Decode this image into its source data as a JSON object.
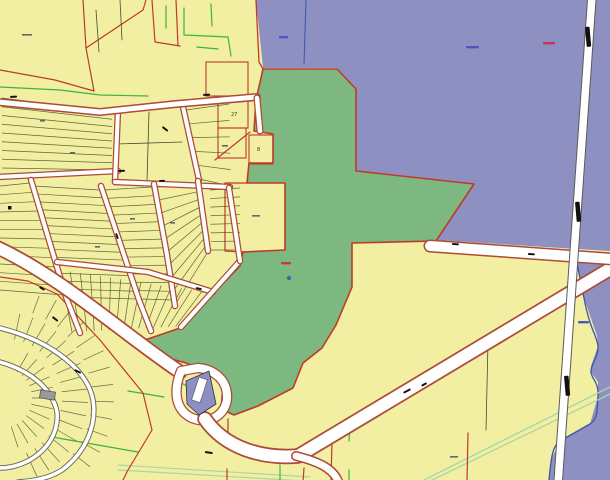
{
  "map": {
    "canvas": {
      "width": 610,
      "height": 480
    },
    "parcel_labels": {
      "p27": "27",
      "p8": "8"
    },
    "palette": {
      "base_yellow": "#f2eea2",
      "region_purple": "#8e90c1",
      "parcel_green": "#7cb87f",
      "road_white": "#ffffff",
      "boundary_red": "#c0392b",
      "casing_red": "#ad4a38",
      "road_gray": "#5a5a5a",
      "sub_casing": "#6e6e58",
      "lot_line": "#44502c",
      "subdiv_line": "#5a6140",
      "bright_green": "#3bb53b",
      "stream_green": "#a6d7a6",
      "river_blue": "#3d55a6",
      "site_purple": "#8d8fc4",
      "building_gray": "#9a9a9a",
      "mark_black": "#141414",
      "mark_red": "#c23558",
      "mark_blue": "#4d55bd",
      "mark_gray": "#666666",
      "label_dark": "#333333"
    }
  }
}
